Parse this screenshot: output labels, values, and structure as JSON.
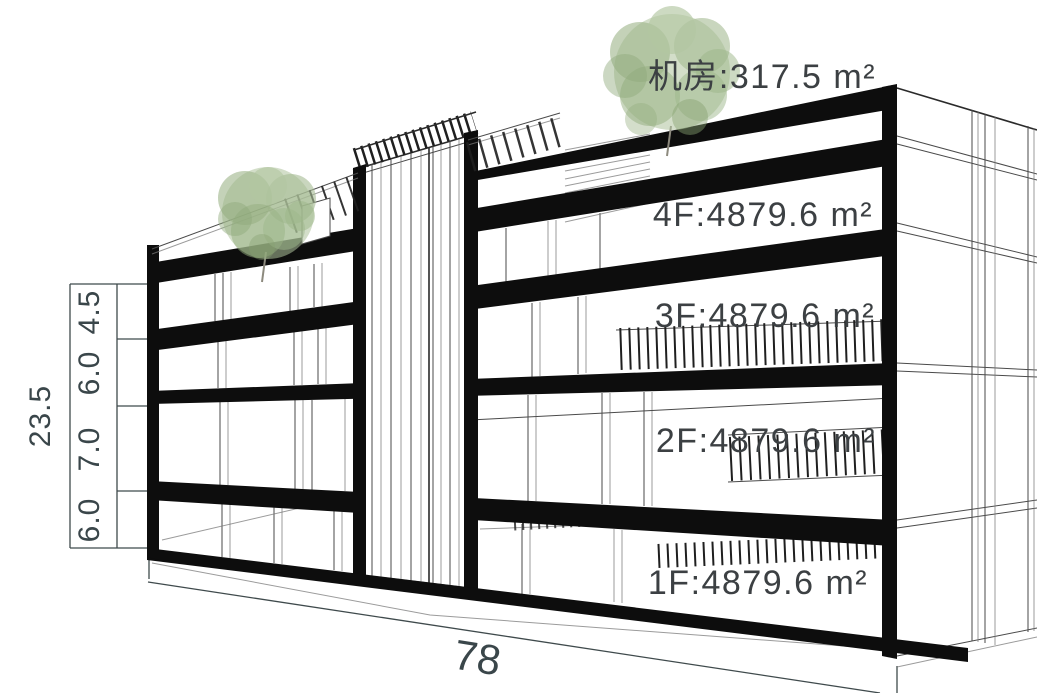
{
  "diagram": {
    "type": "building-section-axonometric",
    "floors": [
      {
        "id": "machine-room",
        "label": "机房:317.5 m²"
      },
      {
        "id": "4f",
        "label": "4F:4879.6 m²"
      },
      {
        "id": "3f",
        "label": "3F:4879.6 m²"
      },
      {
        "id": "2f",
        "label": "2F:4879.6 m²"
      },
      {
        "id": "1f",
        "label": "1F:4879.6 m²"
      }
    ],
    "dimensions": {
      "total_height": "23.5",
      "segments": [
        "4.5",
        "6.0",
        "7.0",
        "6.0"
      ],
      "width": "78"
    },
    "colors": {
      "slab_black": "#0d0d0d",
      "line_gray": "#4a4a4a",
      "label_text": "#3c4043",
      "dim_text": "#3a464a",
      "tree_green": "#9cb489",
      "background": "#ffffff"
    }
  }
}
